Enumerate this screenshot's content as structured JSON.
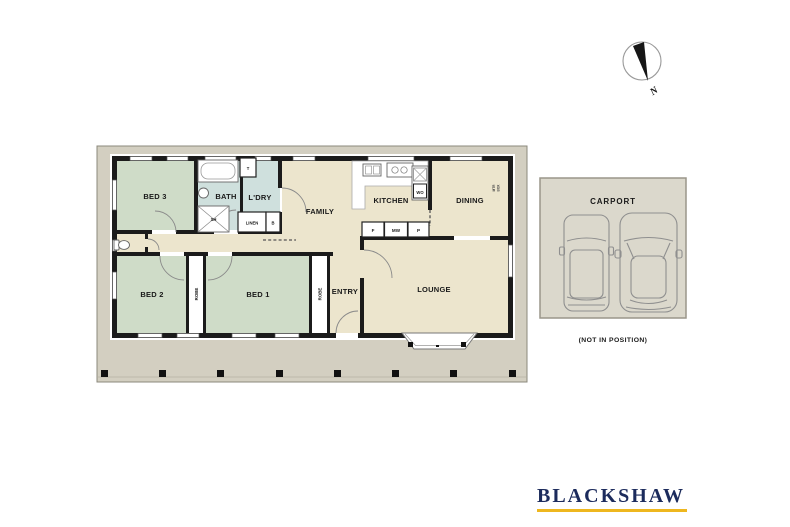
{
  "floorplan": {
    "rooms": {
      "bed3": "BED 3",
      "bed2": "BED 2",
      "bed1": "BED 1",
      "bath": "BATH",
      "laundry": "L'DRY",
      "family": "FAMILY",
      "kitchen": "KITCHEN",
      "dining": "DINING",
      "lounge": "LOUNGE",
      "entry": "ENTRY"
    },
    "labels": {
      "toilet": "T",
      "shower": "SH",
      "linen": "LINEN",
      "broom": "B",
      "wall_oven": "WO",
      "fridge": "F",
      "microwave": "MW",
      "pantry": "P",
      "robe": "ROBE",
      "meter_line1": "MTR",
      "meter_line2": "BOX"
    }
  },
  "carport": {
    "title": "CARPORT",
    "note": "(NOT IN POSITION)"
  },
  "compass": {
    "north": "N"
  },
  "branding": {
    "name": "BLACKSHAW"
  },
  "colors": {
    "bedroom": "#cfdcc8",
    "wet_area": "#cfe0dd",
    "living": "#ece5cd",
    "deck": "#d3cfc1",
    "carport_fill": "#dbd8cc",
    "wall": "#1b1b1b",
    "brand_navy": "#1c2b5c",
    "brand_gold": "#eeb71f"
  }
}
